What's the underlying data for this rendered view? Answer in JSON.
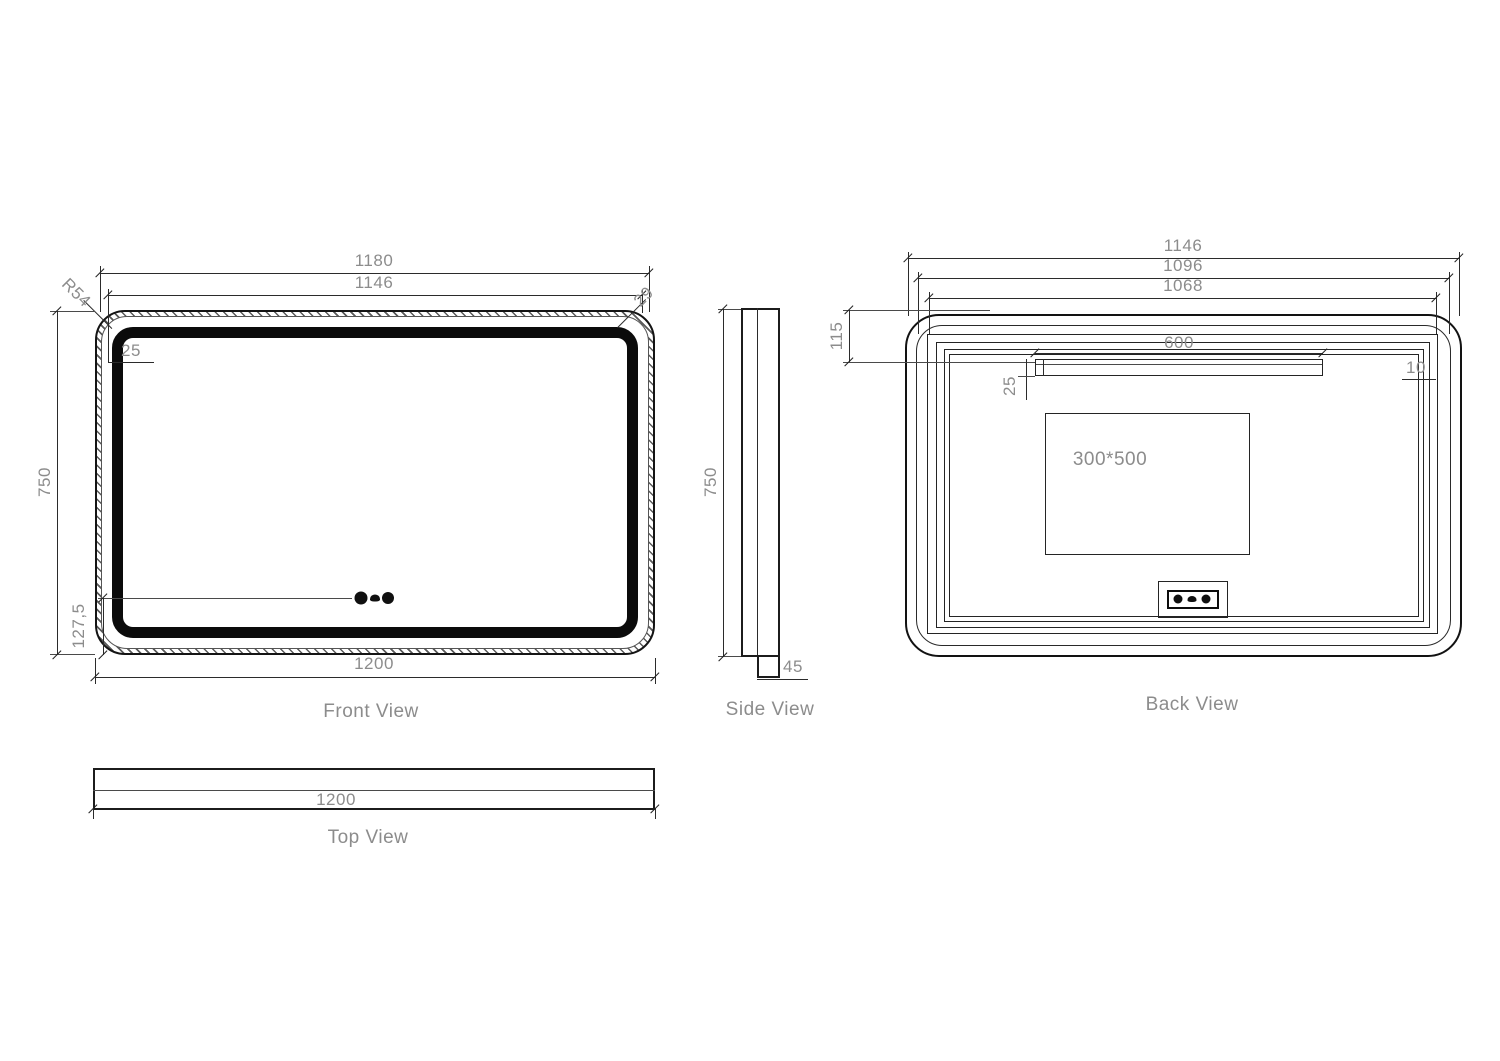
{
  "front": {
    "label": "Front View",
    "dim_width_outer": "1180",
    "dim_width_inner": "1146",
    "dim_total_width": "1200",
    "dim_height": "750",
    "dim_sensor_offset": "127,5",
    "dim_led_inset": "25",
    "dim_corner_radius": "R54",
    "dim_edge_gap": "29"
  },
  "side": {
    "label": "Side View",
    "dim_height": "750",
    "dim_depth": "45"
  },
  "back": {
    "label": "Back View",
    "dim_width_outer": "1146",
    "dim_width_mid": "1096",
    "dim_width_inner": "1068",
    "dim_top_offset": "115",
    "dim_bracket_width": "600",
    "dim_bracket_height": "25",
    "dim_frame_gap": "10",
    "dim_defogger_size": "300*500"
  },
  "top": {
    "label": "Top View",
    "dim_width": "1200"
  },
  "icons": {
    "front_sensors": [
      "power-sensor-icon",
      "defog-sensor-icon",
      "dimmer-sensor-icon"
    ],
    "junction_box": [
      "power-port-icon",
      "defog-port-icon",
      "dimmer-port-icon"
    ]
  },
  "colors": {
    "line": "#1c1c1c",
    "dim_text": "#8c8c8c",
    "led_strip": "#0b0b0b"
  }
}
